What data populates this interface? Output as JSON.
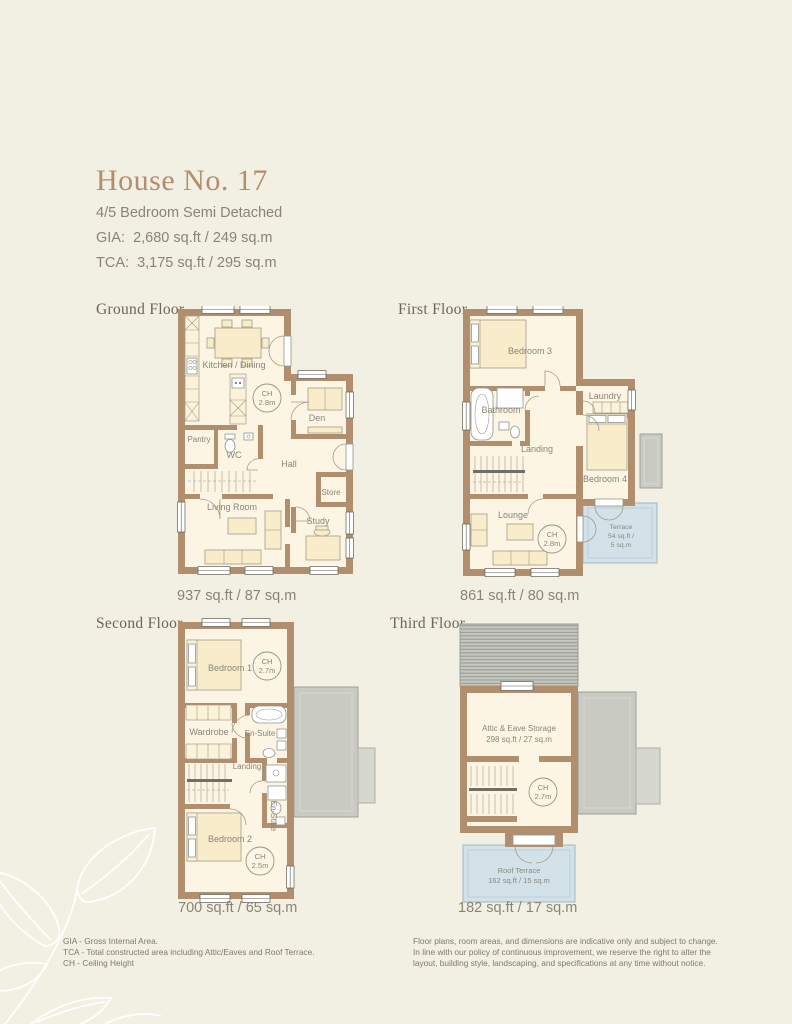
{
  "header": {
    "title": "House No. 17",
    "subtitle": "4/5 Bedroom Semi Detached",
    "gia": "GIA:  2,680 sq.ft / 249 sq.m",
    "tca": "TCA:  3,175 sq.ft / 295 sq.m"
  },
  "floors": {
    "ground": {
      "label": "Ground Floor",
      "area": "937 sq.ft / 87 sq.m",
      "rooms": {
        "kitchen": "Kitchen / Dining",
        "den": "Den",
        "pantry": "Pantry",
        "wc": "WC",
        "hall": "Hall",
        "store": "Store",
        "living": "Living Room",
        "study": "Study"
      },
      "ch": {
        "l1": "CH",
        "l2": "2.8m"
      }
    },
    "first": {
      "label": "First Floor",
      "area": "861 sq.ft / 80 sq.m",
      "rooms": {
        "bedroom3": "Bedroom 3",
        "bathroom": "Bathroom",
        "laundry": "Laundry",
        "landing": "Landing",
        "bedroom4": "Bedroom 4",
        "lounge": "Lounge"
      },
      "ch": {
        "l1": "CH",
        "l2": "2.8m"
      },
      "terrace": {
        "t1": "Terrace",
        "t2": "54 sq.ft /",
        "t3": "5 sq.m"
      }
    },
    "second": {
      "label": "Second Floor",
      "area": "700 sq.ft / 65 sq.m",
      "rooms": {
        "bedroom1": "Bedroom 1",
        "wardrobe": "Wardrobe",
        "ensuite1": "En-Suite",
        "landing": "Landing",
        "ensuite2": "En-Suite",
        "bedroom2": "Bedroom 2"
      },
      "ch1": {
        "l1": "CH",
        "l2": "2.7m"
      },
      "ch2": {
        "l1": "CH",
        "l2": "2.5m"
      }
    },
    "third": {
      "label": "Third Floor",
      "area": "182 sq.ft / 17 sq.m",
      "attic": {
        "l1": "Attic & Eave Storage",
        "l2": "298 sq.ft / 27 sq.m"
      },
      "ch": {
        "l1": "CH",
        "l2": "2.7m"
      },
      "roof_terrace": {
        "l1": "Roof Terrace",
        "l2": "162 sq.ft / 15 sq.m"
      }
    }
  },
  "footer": {
    "notes": [
      "GIA - Gross Internal Area.",
      "TCA - Total constructed area including Attic/Eaves and Roof Terrace.",
      "CH - Ceiling Height"
    ],
    "disclaimer": [
      "Floor plans, room areas, and dimensions are indicative only and subject to change.",
      "In line with our policy of continuous improvement, we reserve the right to alter the",
      "layout, building style, landscaping, and specifications at any time without notice."
    ]
  },
  "colors": {
    "background": "#f2efe3",
    "wall": "#b18e6e",
    "floor_fill": "#fdf5e4",
    "title": "#b48d6e",
    "terrace_blue": "#d3e1e8",
    "roof_gray": "#c9cbc2"
  }
}
